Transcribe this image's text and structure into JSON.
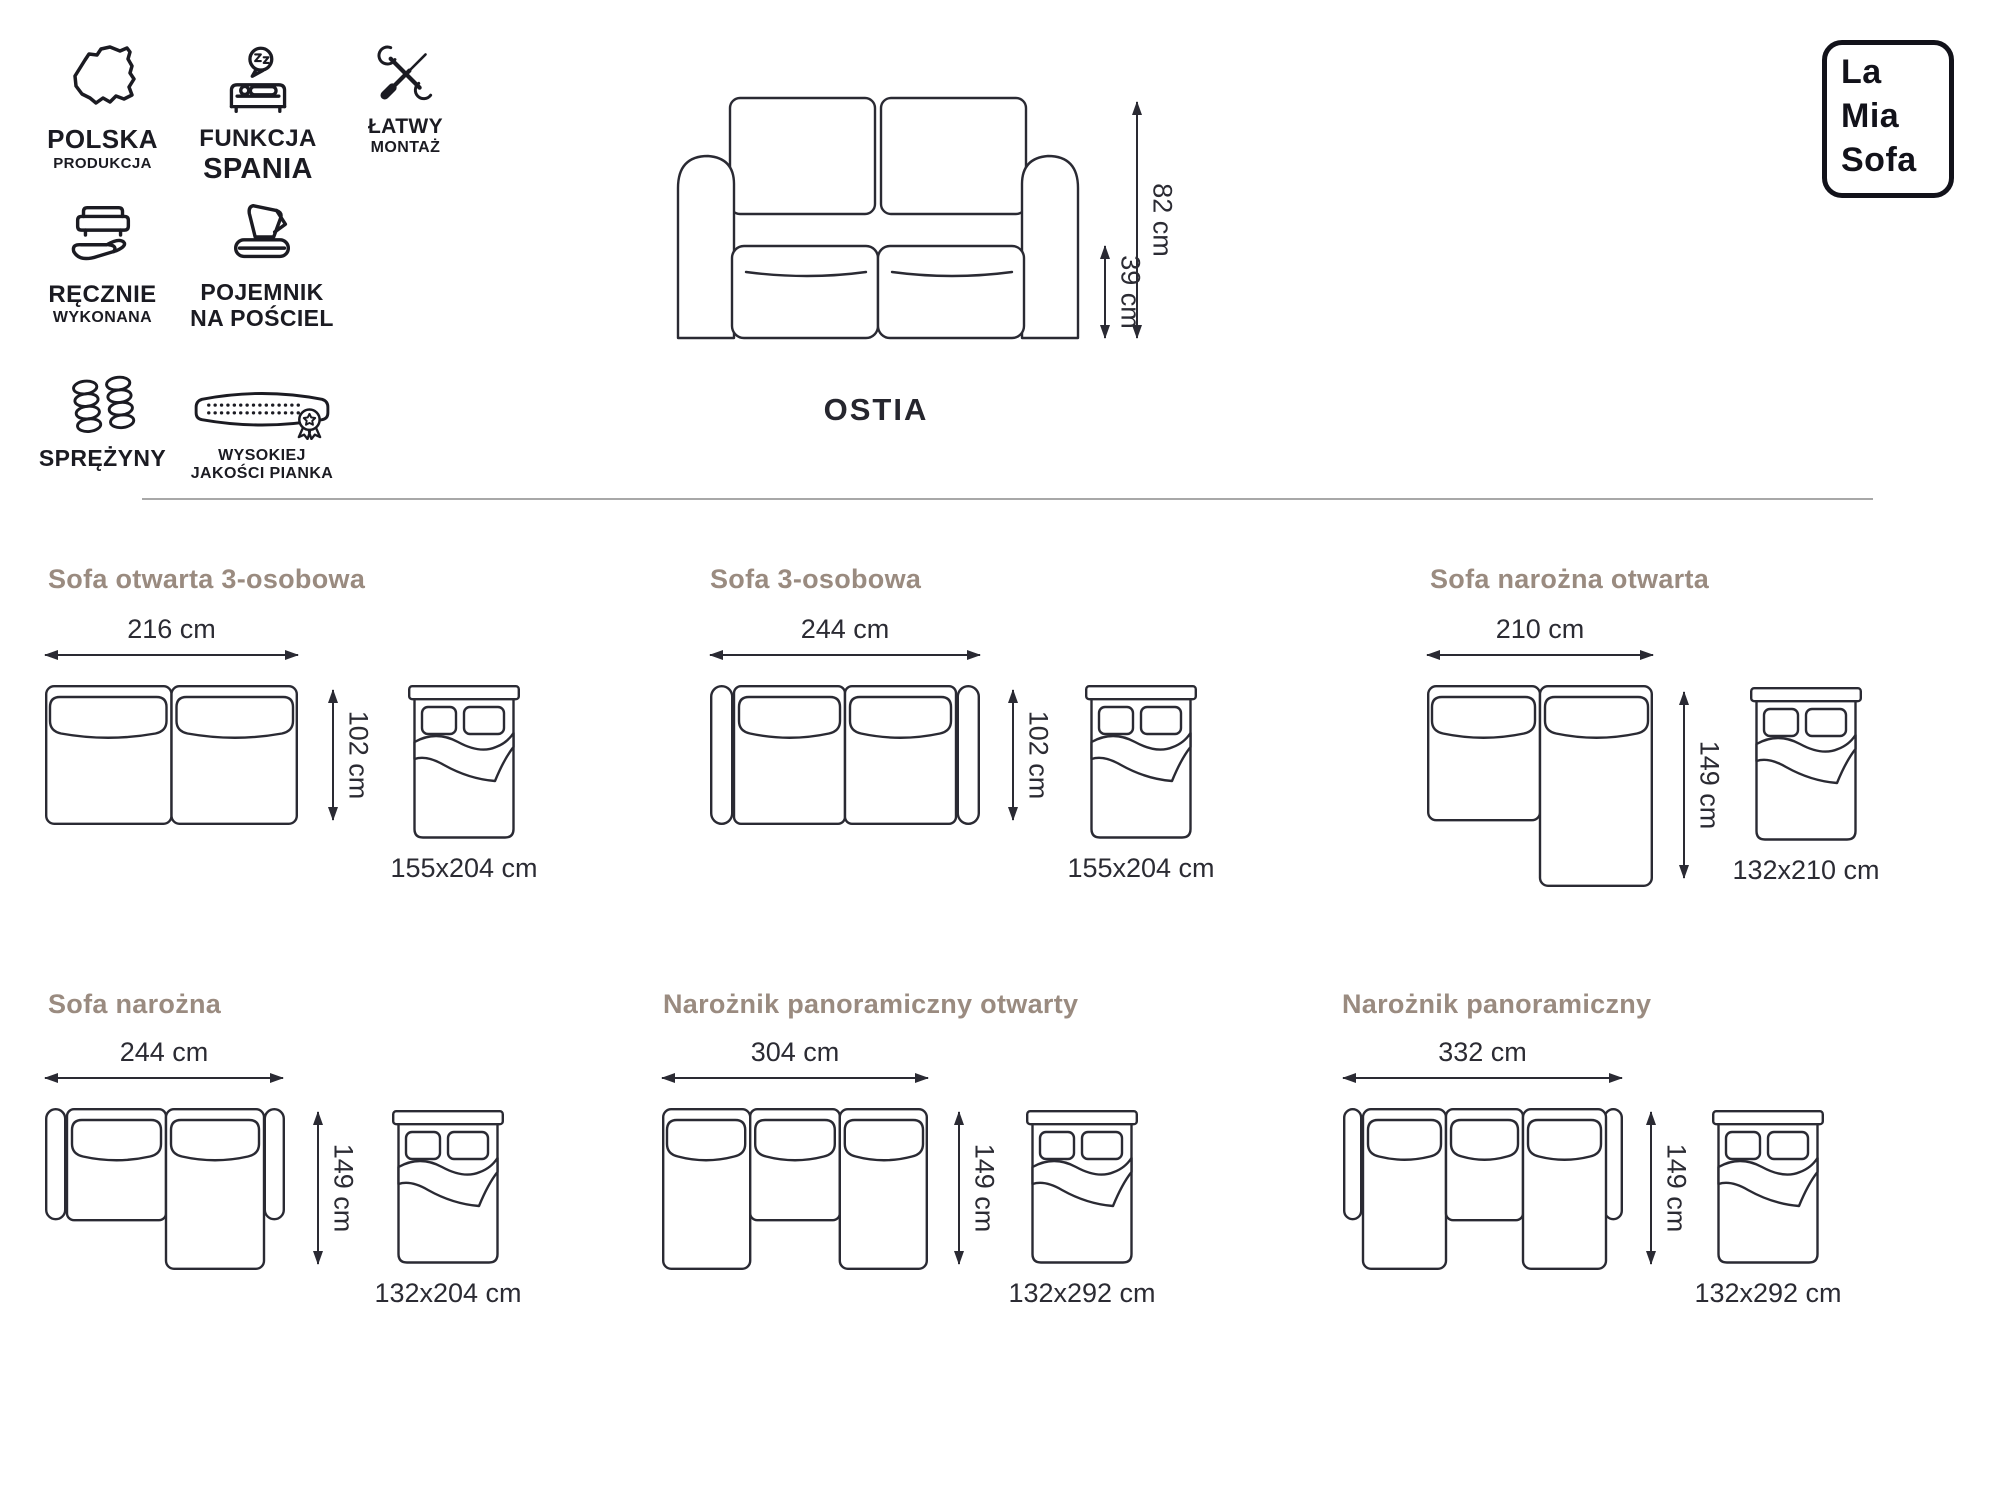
{
  "brand": {
    "line1": "La",
    "line2": "Mia",
    "line3": "Sofa"
  },
  "product": {
    "name": "OSTIA",
    "total_height": "82 cm",
    "seat_height": "39 cm"
  },
  "features": [
    {
      "icon": "poland-map-icon",
      "line1": "POLSKA",
      "line2": "PRODUKCJA"
    },
    {
      "icon": "sleep-function-icon",
      "line1": "FUNKCJA",
      "line2": "SPANIA"
    },
    {
      "icon": "easy-assembly-icon",
      "line1": "ŁATWY",
      "line2": "MONTAŻ"
    },
    {
      "icon": "handmade-icon",
      "line1": "RĘCZNIE",
      "line2": "WYKONANA"
    },
    {
      "icon": "bedding-storage-icon",
      "line1": "POJEMNIK",
      "line2": "NA POŚCIEL"
    },
    {
      "icon": "springs-icon",
      "line1": "SPRĘŻYNY",
      "line2": ""
    },
    {
      "icon": "foam-icon",
      "line1": "WYSOKIEJ",
      "line2": "JAKOŚCI PIANKA"
    }
  ],
  "configurations": [
    {
      "title": "Sofa otwarta 3-osobowa",
      "width": "216 cm",
      "depth": "102 cm",
      "bed_size": "155x204 cm"
    },
    {
      "title": "Sofa 3-osobowa",
      "width": "244 cm",
      "depth": "102 cm",
      "bed_size": "155x204 cm"
    },
    {
      "title": "Sofa narożna otwarta",
      "width": "210 cm",
      "depth": "149 cm",
      "bed_size": "132x210 cm"
    },
    {
      "title": "Sofa narożna",
      "width": "244 cm",
      "depth": "149 cm",
      "bed_size": "132x204 cm"
    },
    {
      "title": "Narożnik panoramiczny otwarty",
      "width": "304 cm",
      "depth": "149 cm",
      "bed_size": "132x292 cm"
    },
    {
      "title": "Narożnik panoramiczny",
      "width": "332 cm",
      "depth": "149 cm",
      "bed_size": "132x292 cm"
    }
  ],
  "colors": {
    "accent_heading": "#9a8b80",
    "ink": "#26262e",
    "outline": "#2a2a33",
    "divider": "#a8a8a8"
  }
}
